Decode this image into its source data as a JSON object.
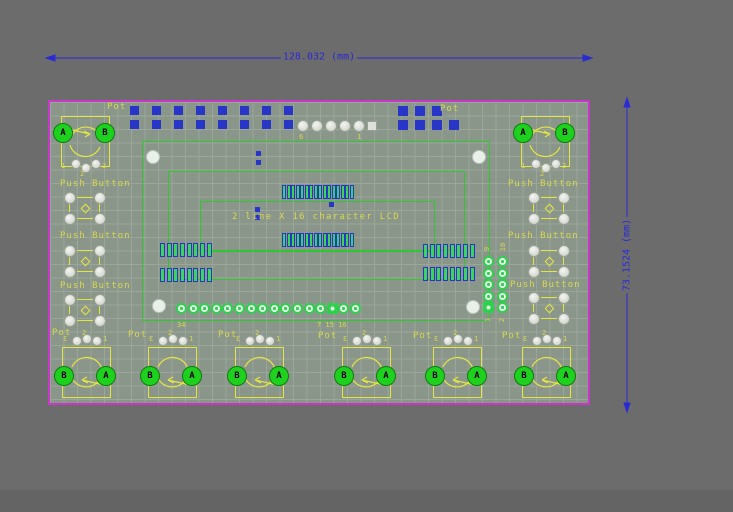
{
  "dimensions": {
    "horizontal": "128.032 (mm)",
    "vertical": "73.1524 (mm)"
  },
  "silkscreen": {
    "lcd_text": "2 line X 16 character LCD",
    "pot_label": "Pot",
    "push_button_label": "Push Button",
    "pad_letter_a": "A",
    "pad_letter_b": "B"
  },
  "pin_labels": {
    "top_header_left": "6",
    "top_header_right": "1",
    "lcd_row_left": "34",
    "lcd_row_right": "7 15 16",
    "side_header_top_left": "9",
    "side_header_top_right": "10",
    "side_header_bottom_left": "1",
    "side_header_bottom_right": "2",
    "pot_pin_1": "1",
    "pot_pin_2": "2",
    "pot_pin_3": "3"
  },
  "colors": {
    "background": "#6c6c6c",
    "board_fill": "#8b968b",
    "grid_line": "#9aa699",
    "board_outline": "#c837c8",
    "trace_green": "#2ec82e",
    "silkscreen_yellow": "#d8d84e",
    "dimension_blue": "#2a2ad6",
    "smd_pad_blue": "#2836c8",
    "pad_green_fill": "#3cd45c",
    "pad_silver": "#dfe2dc",
    "pad_bright_green": "#1fd11f"
  }
}
